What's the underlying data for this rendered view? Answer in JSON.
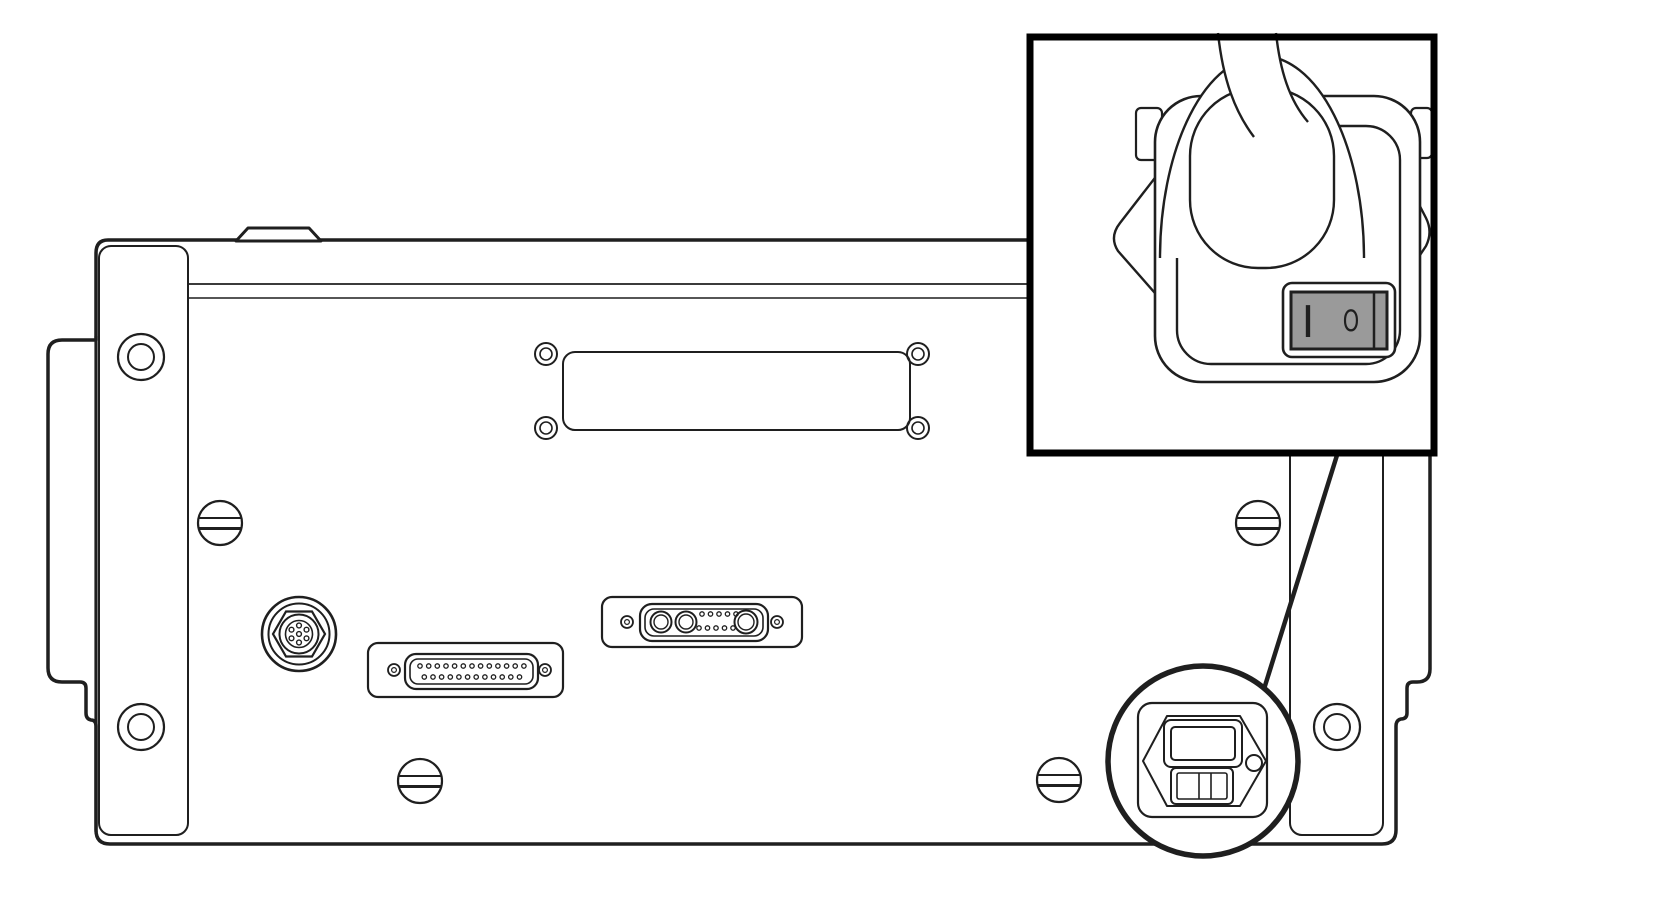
{
  "diagram": {
    "type": "technical-line-illustration",
    "subject": "instrument-rear-panel-with-power-switch-callout",
    "inset": {
      "switch": {
        "on_label": "I",
        "off_label": "O"
      }
    },
    "colors": {
      "line": "#1f1f1f",
      "rocker_gray": "#9a9a9a",
      "background": "#ffffff"
    }
  }
}
